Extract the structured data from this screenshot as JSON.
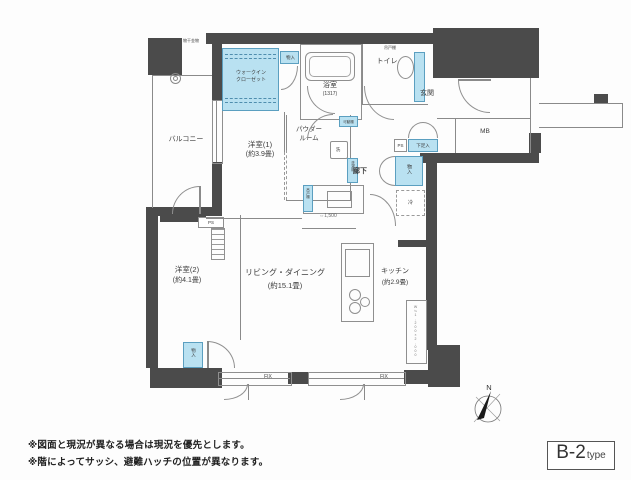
{
  "plan": {
    "type_main": "B-2",
    "type_sub": "type",
    "note1": "※図面と現況が異なる場合は現況を優先とします。",
    "note2": "※階によってサッシ、避難ハッチの位置が異なります。",
    "compass_n": "N"
  },
  "rooms": {
    "balcony": "バルコニー",
    "w1_name": "洋室(1)",
    "w1_size": "(約3.9畳)",
    "w2_name": "洋室(2)",
    "w2_size": "(約4.1畳)",
    "ld_name": "リビング・ダイニング",
    "ld_size": "(約15.1畳)",
    "kitchen_name": "キッチン",
    "kitchen_size": "(約2.9畳)",
    "bath_name": "浴室",
    "bath_size": "(1317)",
    "toilet": "トイレ",
    "entrance": "玄関",
    "hallway": "廊下",
    "powder_line1": "パウダー",
    "powder_line2": "ルーム",
    "wic_line1": "ウォークイン",
    "wic_line2": "クローゼット"
  },
  "storage": {
    "mono_top": "物入",
    "mono_hall": "物入",
    "mono_w2": "物入",
    "shoes": "下足入",
    "fridge": "冷",
    "washer": "洗濯機",
    "basin": "洗",
    "movable_shelf": "可動棚",
    "hanging_shelf": "吊戸棚",
    "counter_shelf": "吊戸棚",
    "ps_hall": "PS",
    "ps_w2": "PS",
    "mb": "MB",
    "laundry_fitting": "物干金物"
  },
  "annotations": {
    "fix_left": "FIX",
    "fix_right": "FIX",
    "dim_counter": "⇔1,500",
    "dim_kitchen": "W≒1,200×2,000"
  }
}
